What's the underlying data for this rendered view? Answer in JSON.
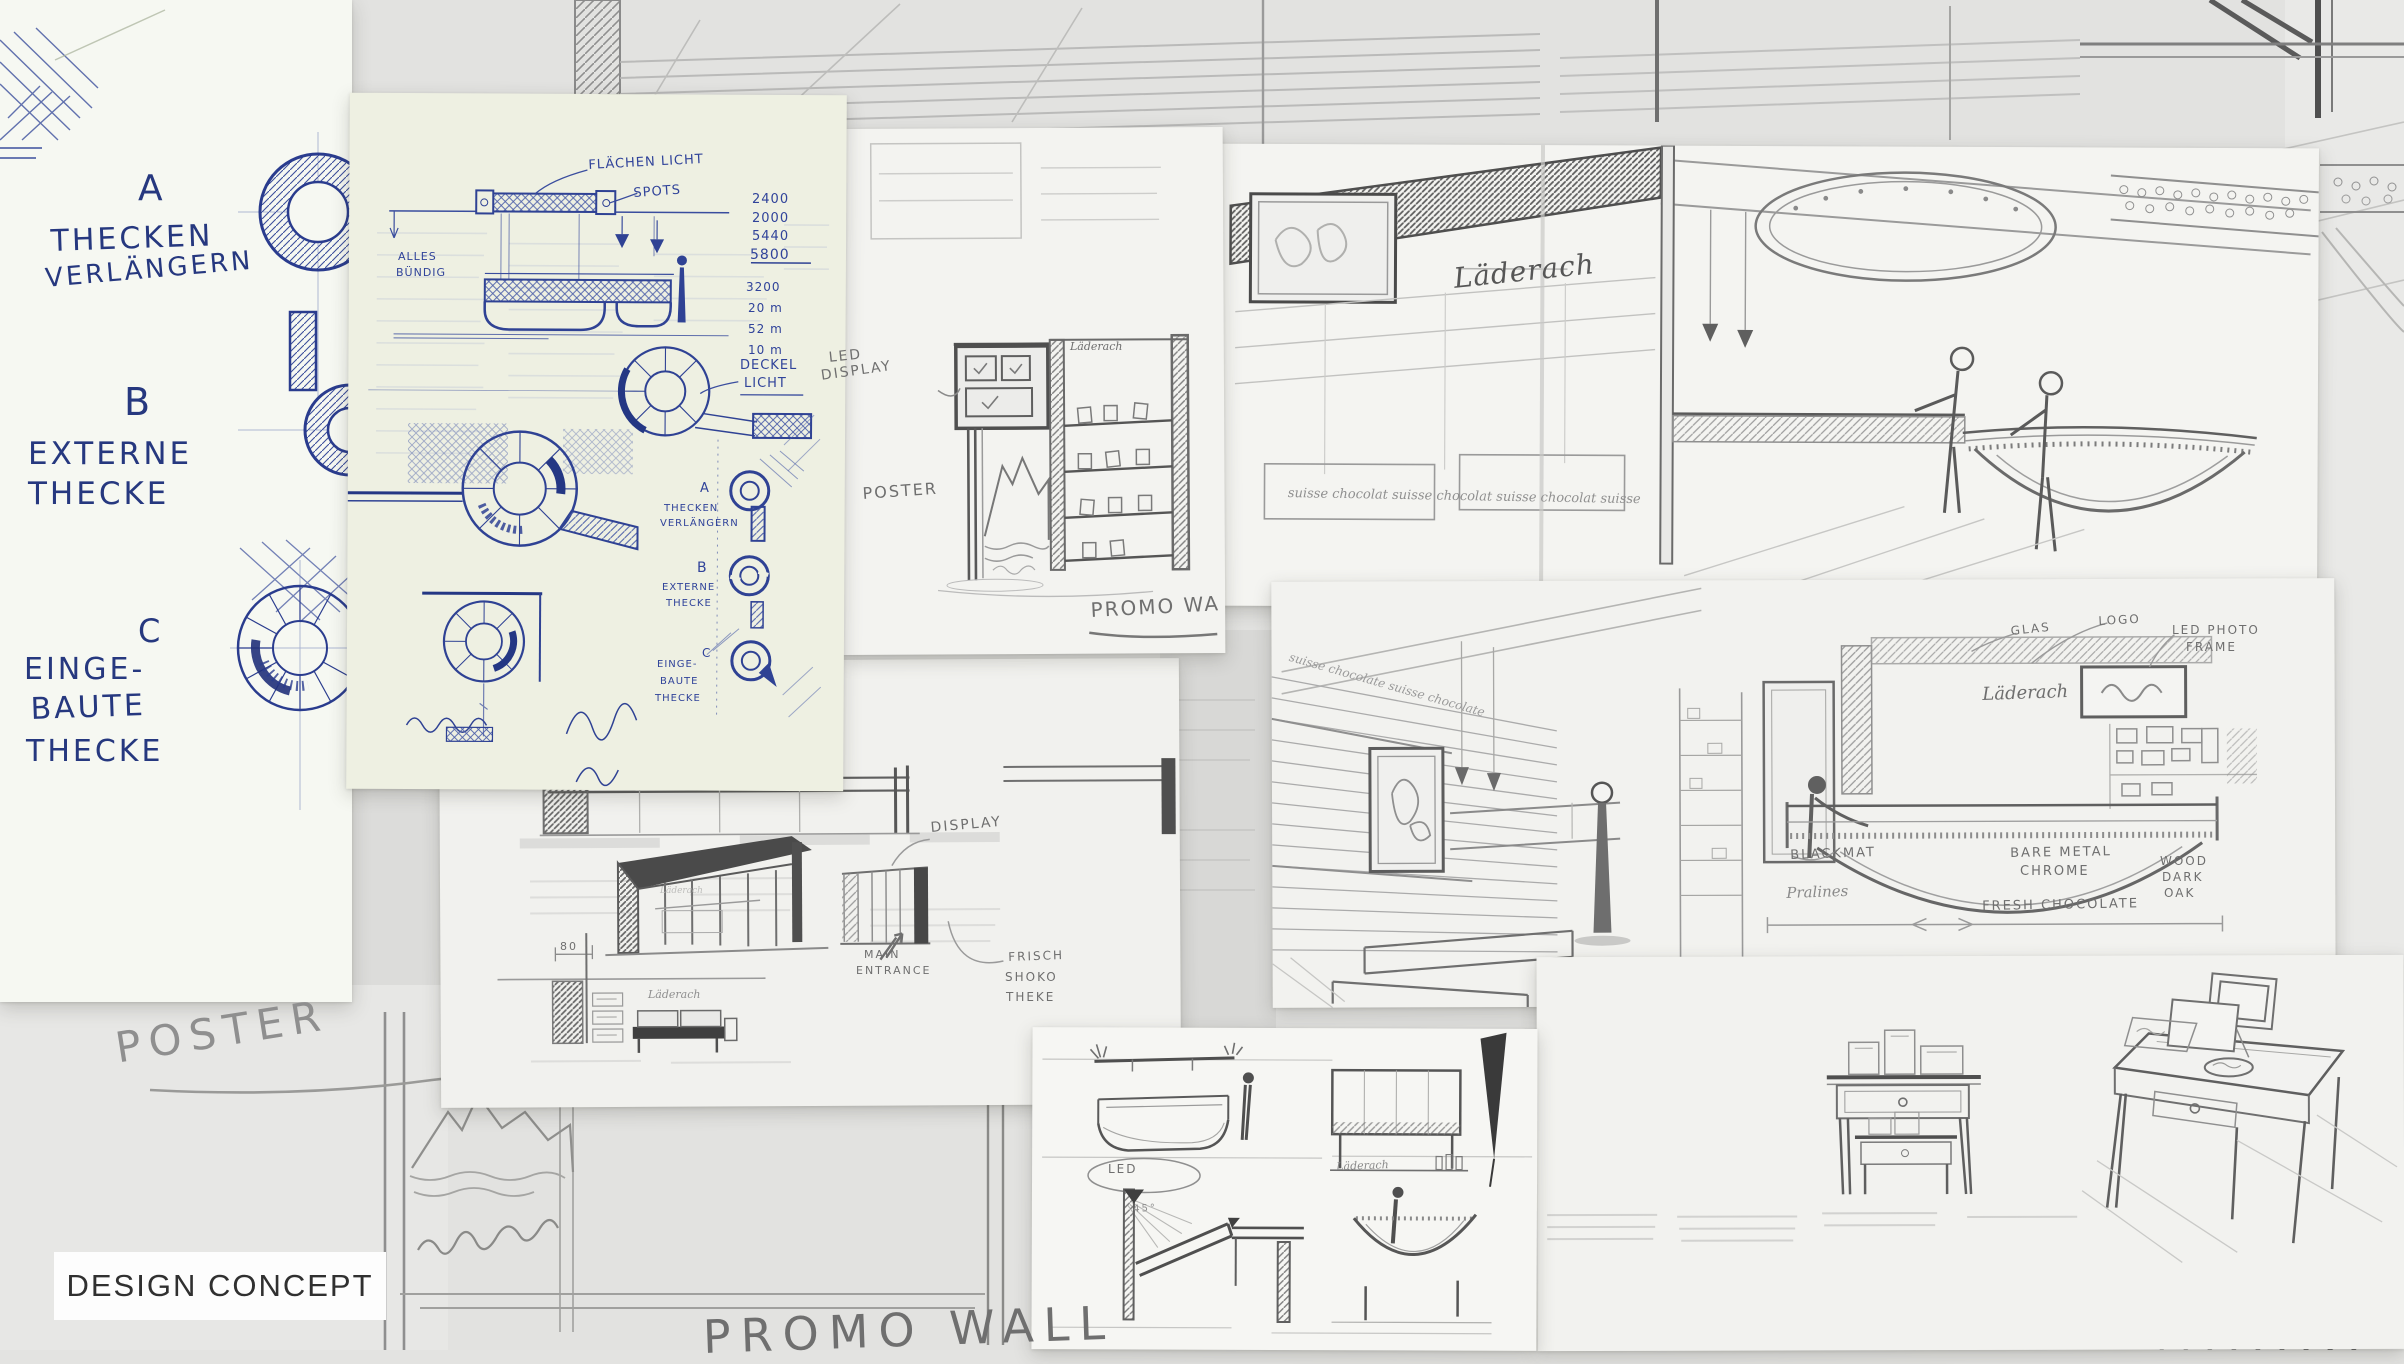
{
  "title": {
    "label": "DESIGN CONCEPT"
  },
  "colors": {
    "pen_blue": "#26387f",
    "pencil": "#6f6f6f",
    "pencil_dark": "#4a4a4a",
    "paper_green": "#eef0e2",
    "paper_white": "#f4f4f1",
    "background": "#e3e3e1"
  },
  "left_notes": {
    "option_a_letter": "A",
    "option_a_line1": "THECKEN",
    "option_a_line2": "VERLÄNGERN",
    "option_b_letter": "B",
    "option_b_line1": "EXTERNE",
    "option_b_line2": "THECKE",
    "option_c_letter": "C",
    "option_c_line1": "EINGE-",
    "option_c_line2": "BAUTE",
    "option_c_line3": "THECKE"
  },
  "plan_sheet": {
    "flaechen_licht": "FLÄCHEN LICHT",
    "spots": "SPOTS",
    "alles_line1": "ALLES",
    "alles_line2": "BÜNDIG",
    "deckel_line1": "DECKEL",
    "deckel_line2": "LICHT",
    "dims_a": [
      "2400",
      "2000",
      "5440",
      "5800"
    ],
    "dims_b": [
      "3200",
      "20 m",
      "52 m",
      "10 m"
    ],
    "opt_a_letter": "A",
    "opt_a_line1": "THECKEN",
    "opt_a_line2": "VERLÄNGERN",
    "opt_b_letter": "B",
    "opt_b_line1": "EXTERNE",
    "opt_b_line2": "THECKE",
    "opt_c_letter": "C",
    "opt_c_line1": "EINGE-",
    "opt_c_line2": "BAUTE",
    "opt_c_line3": "THECKE"
  },
  "tower_sheet": {
    "led_line1": "LED",
    "led_line2": "DISPLAY",
    "poster": "POSTER",
    "brand": "Läderach",
    "promo": "PROMO WA"
  },
  "store_sheet": {
    "brand": "Läderach",
    "script": "suisse chocolat suisse chocolat suisse chocolat suisse"
  },
  "interior_sheet": {
    "script": "suisse chocolate suisse chocolate",
    "brand": "Läderach",
    "glas": "GLAS",
    "logo": "LOGO",
    "led_photo_line1": "LED PHOTO",
    "led_photo_line2": "FRAME",
    "blackmat": "BLACKMAT",
    "pralines": "Pralines",
    "bare_line1": "BARE METAL",
    "bare_line2": "CHROME",
    "wood_line1": "WOOD",
    "wood_line2": "DARK",
    "wood_line3": "OAK",
    "fresh": "FRESH CHOCOLATE"
  },
  "storefront_sheet": {
    "display": "DISPLAY",
    "main_line1": "MAIN",
    "main_line2": "ENTRANCE",
    "frisch_line1": "FRISCH",
    "frisch_line2": "SHOKO",
    "frisch_line3": "THEKE",
    "dim80": "80",
    "brand_small": "Läderach",
    "sign_small": "Läderach"
  },
  "counters_sheet": {
    "led": "LED",
    "angle": "45°",
    "brand": "Läderach"
  },
  "bottom_area": {
    "poster": "POSTER",
    "promo_wall": "PROMO WALL"
  }
}
